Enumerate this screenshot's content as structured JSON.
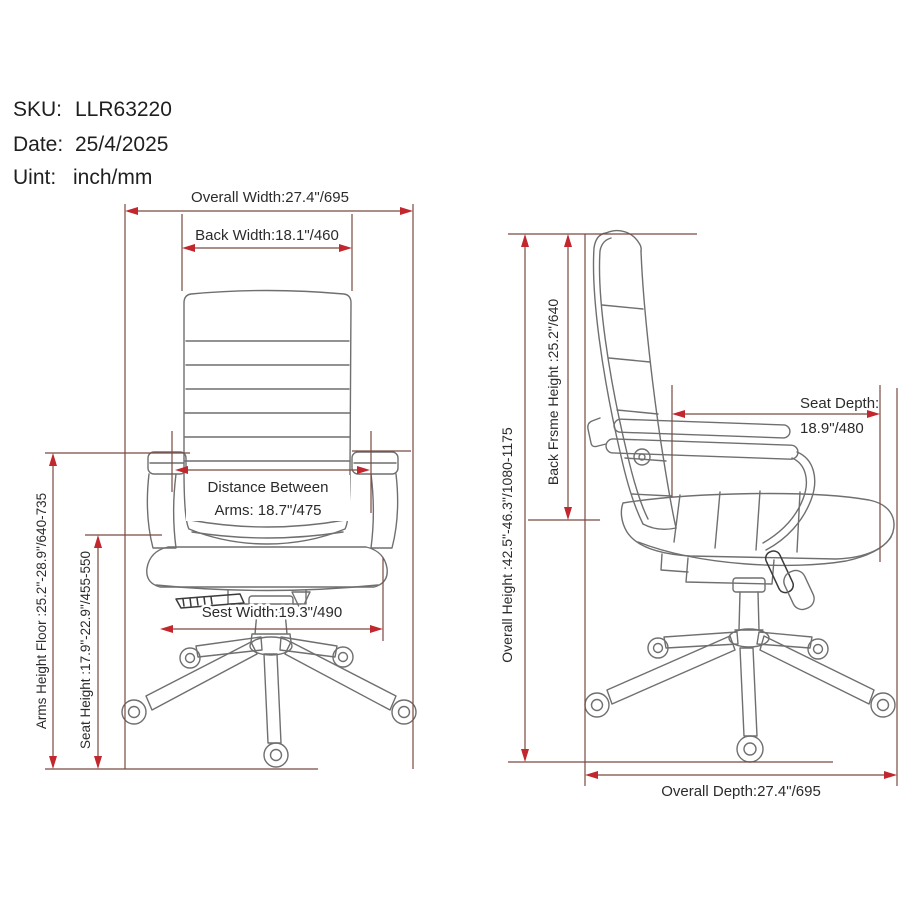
{
  "header": {
    "sku_label": "SKU:",
    "sku_value": "LLR63220",
    "date_label": "Date:",
    "date_value": "25/4/2025",
    "unit_label": "Uint:",
    "unit_value": "inch/mm"
  },
  "front_view": {
    "overall_width": "Overall Width:27.4\"/695",
    "back_width": "Back Width:18.1\"/460",
    "arms_distance_line1": "Distance Between",
    "arms_distance_line2": "Arms: 18.7\"/475",
    "seat_width": "Sest Width:19.3\"/490",
    "arms_height": "Arms Height Floor :25.2\"-28.9\"/640-735",
    "seat_height": "Seat Height :17.9\"-22.9\"/455-550"
  },
  "side_view": {
    "overall_height": "Overall Height :42.5\"-46.3\"/1080-1175",
    "back_frame_height": "Back Frsme Height :25.2\"/640",
    "seat_depth_line1": "Seat Depth:",
    "seat_depth_line2": "18.9\"/480",
    "overall_depth": "Overall Depth:27.4\"/695"
  },
  "colors": {
    "dimension_line": "#7a4a40",
    "arrowhead": "#c1272d",
    "chair_outline": "#6f6f6f",
    "text": "#2b2b2b",
    "background": "#ffffff"
  }
}
